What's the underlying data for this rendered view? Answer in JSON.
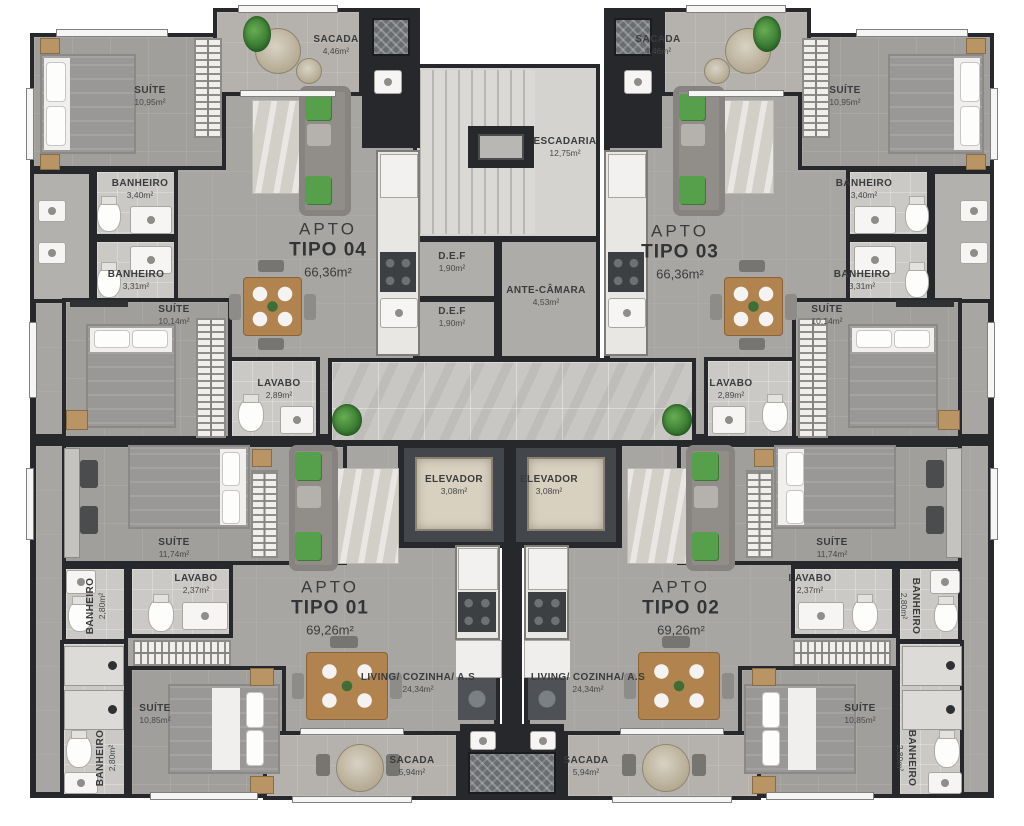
{
  "plan_title": "Floor plan - apartment types",
  "colors": {
    "wall": "#26282b",
    "floor_living": "#a8a6a2",
    "floor_suite": "#a19f9c",
    "floor_bath": "#cbc9c5",
    "floor_balcony": "#b5b2ad",
    "hall_marble": "#c9c7c3",
    "elevator_cab": "#d9d1bf",
    "wood": "#b0834f",
    "plant_green": "#4f9b45"
  },
  "apartments": {
    "apto01": {
      "l1": "APTO",
      "l2": "TIPO 01",
      "area": "69,26m²"
    },
    "apto02": {
      "l1": "APTO",
      "l2": "TIPO 02",
      "area": "69,26m²"
    },
    "apto03": {
      "l1": "APTO",
      "l2": "TIPO 03",
      "area": "66,36m²"
    },
    "apto04": {
      "l1": "APTO",
      "l2": "TIPO 04",
      "area": "66,36m²"
    }
  },
  "labels": {
    "suite_1095": {
      "name": "SUÍTE",
      "area": "10,95m²"
    },
    "suite_1014": {
      "name": "SUÍTE",
      "area": "10,14m²"
    },
    "suite_1174": {
      "name": "SUÍTE",
      "area": "11,74m²"
    },
    "suite_1085": {
      "name": "SUÍTE",
      "area": "10,85m²"
    },
    "banheiro_340": {
      "name": "BANHEIRO",
      "area": "3,40m²"
    },
    "banheiro_331": {
      "name": "BANHEIRO",
      "area": "3,31m²"
    },
    "banheiro_280": {
      "name": "BANHEIRO",
      "area": "2,80m²"
    },
    "lavabo_289": {
      "name": "LAVABO",
      "area": "2,89m²"
    },
    "lavabo_237": {
      "name": "LAVABO",
      "area": "2,37m²"
    },
    "sacada_446": {
      "name": "SACADA",
      "area": "4,46m²"
    },
    "sacada_594": {
      "name": "SACADA",
      "area": "5,94m²"
    },
    "living": {
      "name": "LIVING/ COZINHA/ A.S",
      "area": "24,34m²"
    },
    "elevador": {
      "name": "ELEVADOR",
      "area": "3,08m²"
    },
    "escadaria": {
      "name": "ESCADARIA",
      "area": "12,75m²"
    },
    "def": {
      "name": "D.E.F",
      "area": "1,90m²"
    },
    "antecamara": {
      "name": "ANTE-CÂMARA",
      "area": "4,53m²"
    }
  }
}
